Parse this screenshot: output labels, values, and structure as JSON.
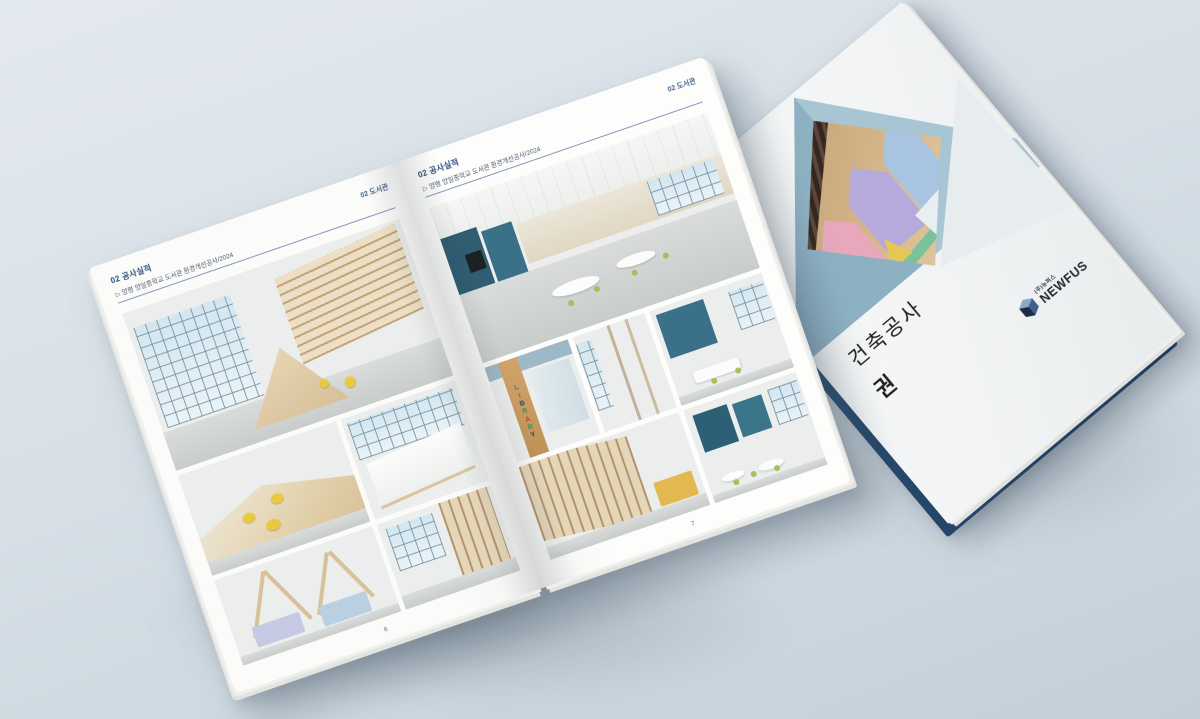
{
  "scene": {
    "background_color": "#d9e1e8"
  },
  "open_book": {
    "left_page": {
      "section_label": "02 공사실적",
      "project_label": "▷ 양평 양일중학교 도서관 환경개선공사/2024",
      "corner_label": "02 도서관",
      "page_number": "6",
      "photos": {
        "a": "library hall with window wall, curved wooden bookshelf and house-frame reading nooks",
        "b": "stepped wooden platform seating with round yellow cushions",
        "c": "white sculptural reception counter in front of windows",
        "d": "house-frame study nooks with pastel cushions",
        "e": "wooden shelving detail beside windows"
      }
    },
    "right_page": {
      "section_label": "02 공사실적",
      "project_label": "▷ 양평 양일중학교 도서관 환경개선공사/2024",
      "corner_label": "02 도서관",
      "page_number": "7",
      "library_sign": {
        "text": "LIBRARY",
        "letter_colors": [
          "#4a74b0",
          "#bb4a42",
          "#2c3f72",
          "#3e8f63",
          "#bb4a42",
          "#3e8f63",
          "#2c3f72"
        ]
      },
      "photos": {
        "a": "library classroom with white tables, green chairs, teal accent walls and monitors",
        "b": "entrance corridor with vertical LIBRARY lettering on a wood panel",
        "c": "beige partition and doorway detail",
        "d": "study corner with blue accent wall and white table",
        "e": "wooden bookshelf aisle with yellow bench",
        "f": "reading room with teal panels and round white tables"
      }
    }
  },
  "cover_book": {
    "title_line1": "건축공사",
    "title_line2": "권",
    "logo_korean": "(주)뉴퍼스",
    "logo_name": "NEWFUS",
    "photo": "colourful children's library with hexagonal wall nooks and dark slatted ceiling",
    "colors": {
      "triangle_dark": "#8db0c3",
      "triangle_light": "#a8c5d4",
      "back_board_navy": "#24466a",
      "header_navy": "#2e4d7b",
      "rule_blue": "#8299bb",
      "accent_yellow": "#eac93f",
      "accent_teal": "#376c84"
    }
  }
}
